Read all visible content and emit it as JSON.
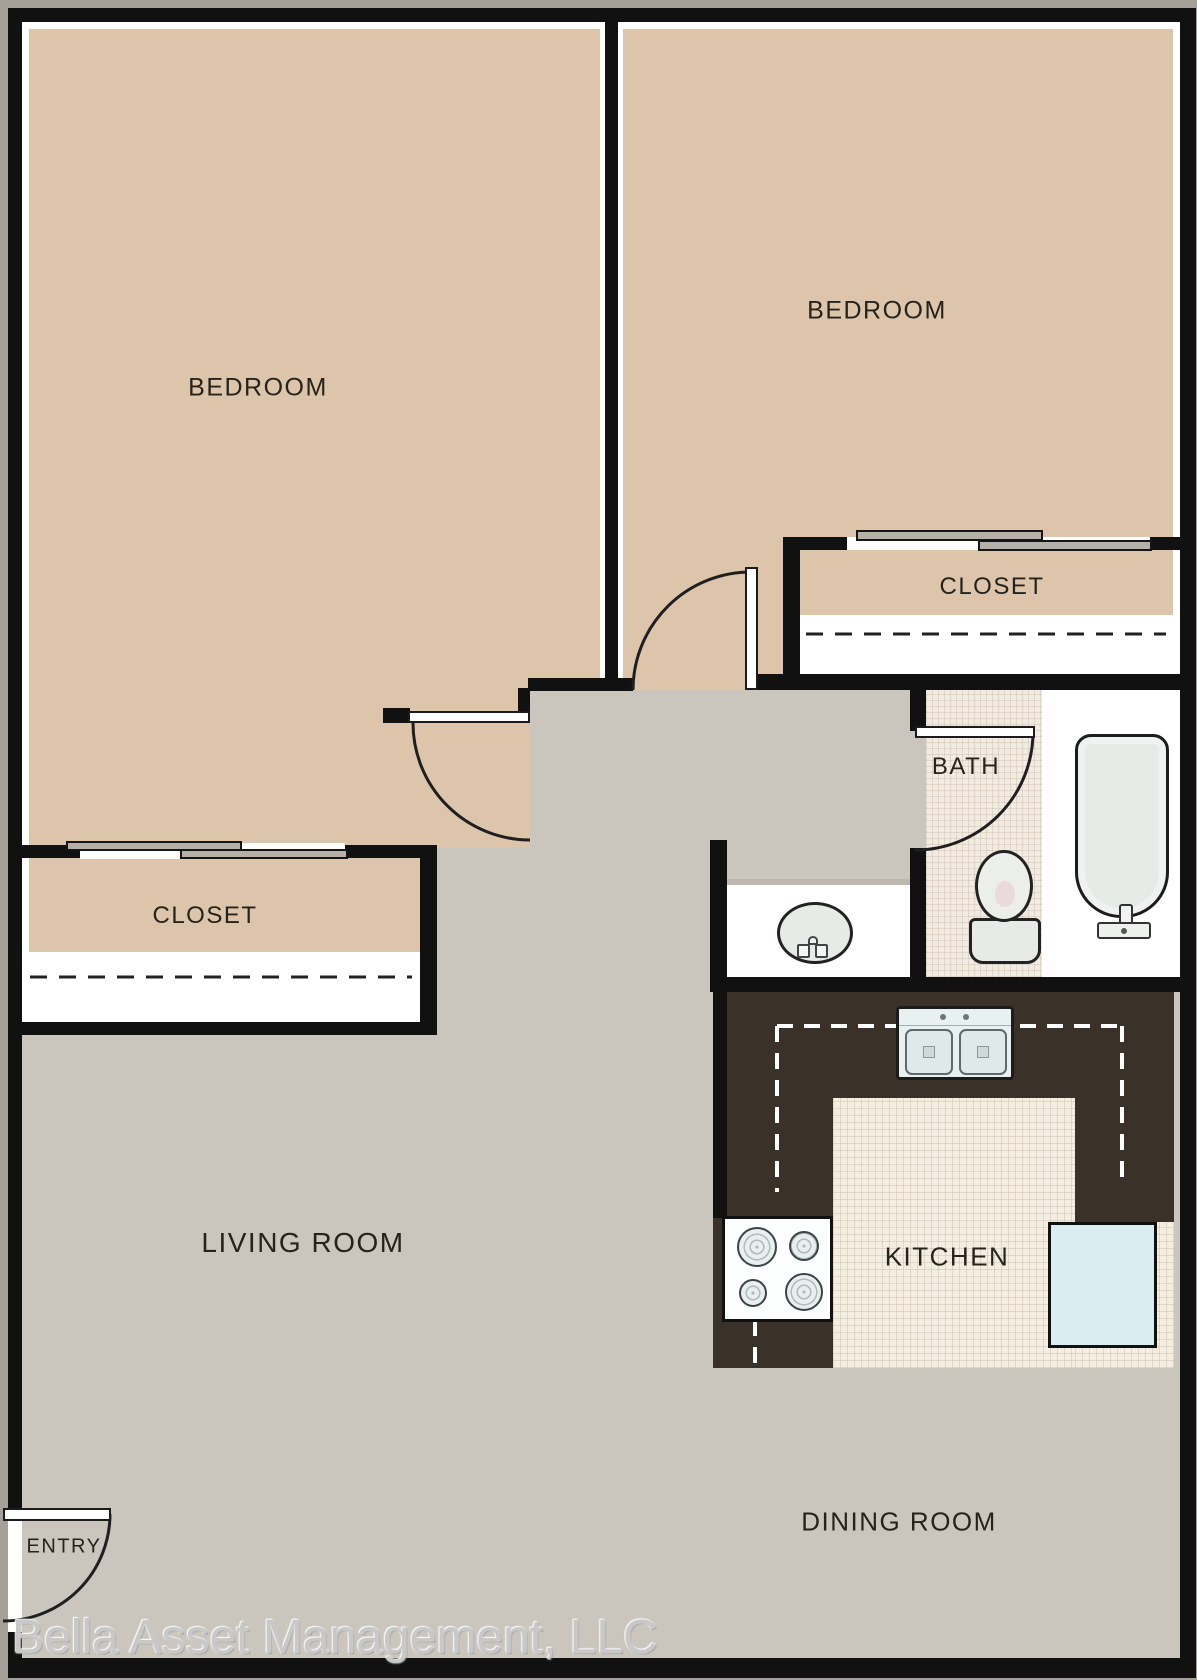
{
  "plan": {
    "type": "apartment-floor-plan",
    "rooms": {
      "bedroom_left": {
        "label": "BEDROOM"
      },
      "bedroom_right": {
        "label": "BEDROOM"
      },
      "closet_right": {
        "label": "CLOSET"
      },
      "closet_left": {
        "label": "CLOSET"
      },
      "bath": {
        "label": "BATH"
      },
      "living_room": {
        "label": "LIVING ROOM"
      },
      "kitchen": {
        "label": "KITCHEN"
      },
      "dining_room": {
        "label": "DINING ROOM"
      },
      "entry": {
        "label": "ENTRY"
      }
    },
    "fixtures": [
      "bathtub",
      "toilet",
      "vanity-sink",
      "kitchen-double-sink",
      "stove",
      "refrigerator"
    ],
    "doors": [
      "entry-swing-door",
      "bedroom-left-swing-door",
      "bedroom-right-swing-door",
      "bath-swing-door",
      "closet-left-sliding-doors",
      "closet-right-sliding-doors"
    ],
    "colors": {
      "walls": "#111111",
      "bedroom_floor": "#dcc5aa",
      "living_floor": "#cac6bd",
      "kitchen_counter": "#3a3129",
      "kitchen_tile": "#f4ede1",
      "refrigerator": "#daeef1",
      "background_margin": "#a5a198"
    }
  },
  "watermark": {
    "text": "Bella Asset Management, LLC"
  }
}
